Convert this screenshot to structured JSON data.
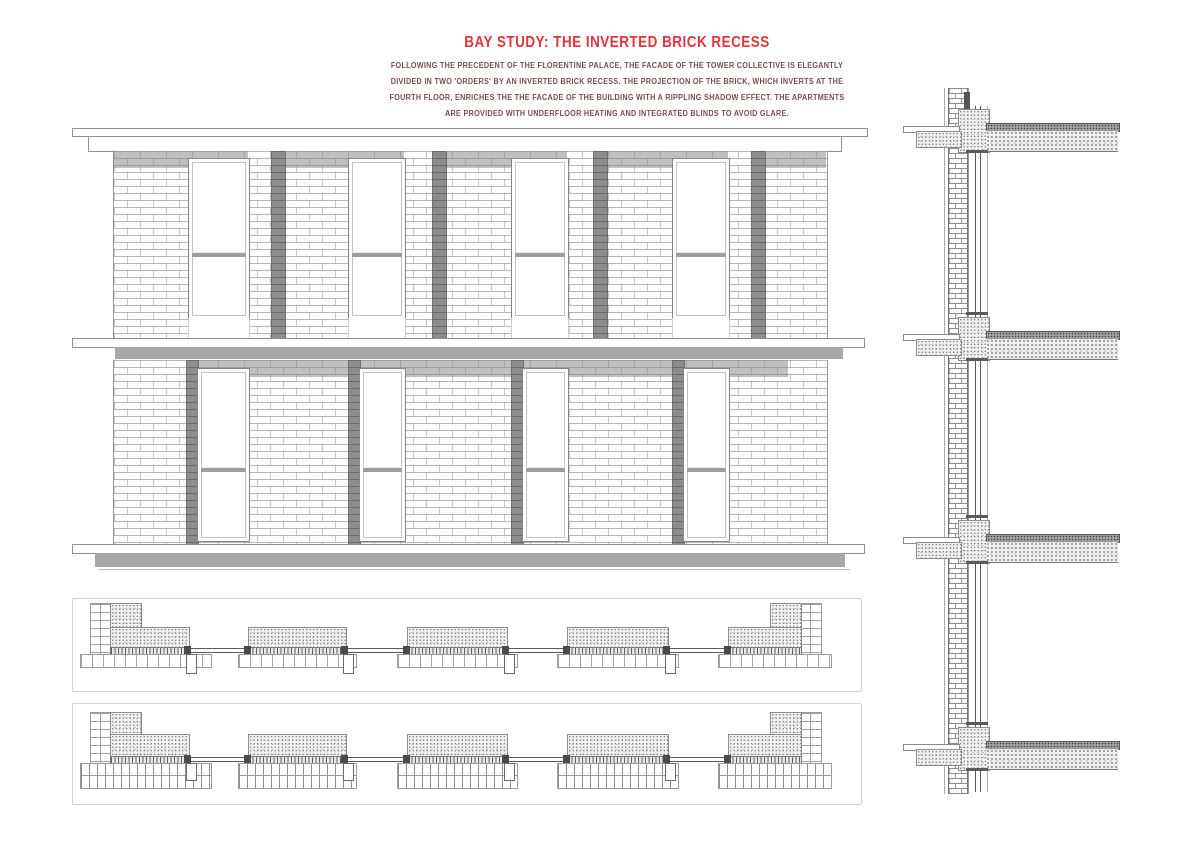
{
  "title": {
    "text": "BAY STUDY: THE INVERTED BRICK RECESS"
  },
  "intro": {
    "lines": [
      "FOLLOWING THE PRECEDENT OF THE FLORENTINE PALACE, THE FACADE OF THE TOWER COLLECTIVE IS  ELEGANTLY",
      "DIVIDED IN TWO 'ORDERS' BY AN INVERTED BRICK RECESS. THE PROJECTION OF THE BRICK, WHICH INVERTS AT THE",
      "FOURTH FLOOR, ENRICHES THE THE FACADE OF THE BUILDING WITH A RIPPLING SHADOW EFFECT. THE APARTMENTS",
      "ARE PROVIDED WITH UNDERFLOOR HEATING AND INTEGRATED BLINDS TO AVOID GLARE."
    ]
  },
  "figures": {
    "upper_bay_elevation": {
      "type": "brick facade elevation",
      "windows": 4,
      "recess_strips": 4
    },
    "lower_bay_elevation": {
      "type": "brick facade elevation",
      "windows": 4,
      "recess_strips": 4
    },
    "plan_details": {
      "count": 2,
      "type": "horizontal section through window bays"
    },
    "wall_section": {
      "type": "vertical facade section",
      "floor_slabs": 4
    }
  },
  "palette": {
    "accent_red": "#e3333d",
    "body_text_red": "#74504b",
    "shadow_gray": "#a8a8a8",
    "recess_gray": "#8d8d8d",
    "line_gray": "#9a9a9a",
    "paper": "#ffffff"
  }
}
